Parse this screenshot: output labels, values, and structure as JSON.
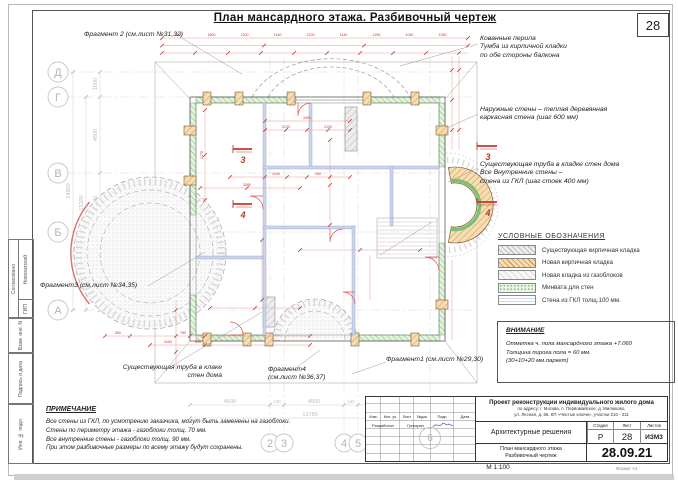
{
  "sheet": {
    "title": "План мансардного этажа. Разбивочный чертеж",
    "number": "28",
    "scale": "М 1:100",
    "format": "Формат А3"
  },
  "grid": {
    "rows": [
      "Д",
      "Г",
      "В",
      "Б",
      "А"
    ],
    "cols": [
      "2",
      "3",
      "4",
      "5"
    ],
    "col_extra": "6",
    "left_dims": [
      "1600",
      "4800",
      "3600",
      "4800"
    ],
    "left_totals": [
      "13200",
      "14800"
    ],
    "bottom_dims": [
      "4500",
      "140",
      "4500",
      "140"
    ],
    "bottom_total": "13780"
  },
  "annotations": {
    "fragment2": "Фрагмент 2 (см.лист №31,32)",
    "fragment3": "Фрагмент3 (см.лист №34,35)",
    "fragment4_l1": "Фрагмент4",
    "fragment4_l2": "(см.лист №36,37)",
    "fragment1": "Фрагмент1 (см.лист №29,30)",
    "railing_l1": "Кованные перила",
    "railing_l2": "Тумба из кирпичной кладки",
    "railing_l3": "по обе стороны балкона",
    "ext_wall_l1": "Наружные стены – теплая деревянная",
    "ext_wall_l2": "каркасная стена (шаг 600 мм)",
    "chimney_r_l1": "Существующая труба в кладке стен дома",
    "chimney_r_l2": "Все Внутренние стены –",
    "chimney_r_l3": "стена из ГКЛ (шаг стоек 400 мм)",
    "chimney_l_l1": "Существующая труба в клаке",
    "chimney_l_l2": "стен дома"
  },
  "sections": {
    "s3": "3",
    "s4": "4"
  },
  "legend": {
    "title": "УСЛОВНЫЕ ОБОЗНАЧЕНИЯ",
    "items": [
      "Существующая кирпичная кладка",
      "Новая кирпичная кладка",
      "Новая кладка из газоблоков",
      "Минвата для стен",
      "Стена из ГКЛ толщ.100 мм."
    ]
  },
  "attention": {
    "title": "ВНИМАНИЕ",
    "lines": [
      "Отметка ч. пола мансардного этажа +7.060",
      "Толщина пирога пола  = 60 мм.",
      "(30+10+20 мм.паркет)"
    ]
  },
  "note": {
    "title": "ПРИМЕЧАНИЕ",
    "lines": [
      "Все стены из ГКЛ, по усмотрению заказчика, могут быть заменены на газоблоки.",
      "Стены по периметру этажа - газоблоки толщ. 70 мм.",
      "Все внутренние стены - газоблоки толщ. 90 мм.",
      "При этом разбивочные размеры по всему этажу будут сохранены."
    ]
  },
  "titleblock": {
    "project_l1": "Проект реконструкции индивидуального жилого дома",
    "project_l2": "по адресу:  г. Москва, п. Первомайское, д. Милюково,",
    "project_l3": "ул. Лесная, д. 66, КП «Чистые ключи», участки 210 - 211",
    "discipline": "Архитектурные решения",
    "stage_label": "Стадия",
    "sheet_label": "Лист",
    "sheets_label": "Листов",
    "stage": "Р",
    "sheet": "28",
    "sheets": "ИЗМ3",
    "doc_l1": "План мансардного этажа",
    "doc_l2": "Разбивочный чертеж",
    "date": "28.09.21",
    "rev_cols": [
      "Изм.",
      "Кол. уч.",
      "Лист",
      "№док.",
      "Подп.",
      "Дата"
    ],
    "developer_label": "Разработал",
    "developer": "Григорян"
  },
  "side_stamp": {
    "approved": "Согласовано",
    "gip": "ГИП",
    "gip_name": "Новохатский",
    "vzam": "Взам. инв. N",
    "podpis": "Подпись и дата",
    "inv": "Инв. № подл."
  },
  "plan_dims": {
    "top": [
      "1200",
      "1800",
      "1200",
      "1140",
      "2100",
      "1140",
      "1250",
      "1040",
      "1250"
    ],
    "interior": [
      "3400",
      "2130",
      "2130",
      "1040",
      "950",
      "3080",
      "2475"
    ],
    "bottom_red": [
      "550",
      "780",
      "4150",
      "640"
    ]
  },
  "colors": {
    "dim_red": "#c0392b",
    "wall_green": "#7bbf78",
    "brick_orange": "#c98c45",
    "hatch_gray": "#b2b2b2",
    "gkl_blue": "#9db0d0"
  }
}
